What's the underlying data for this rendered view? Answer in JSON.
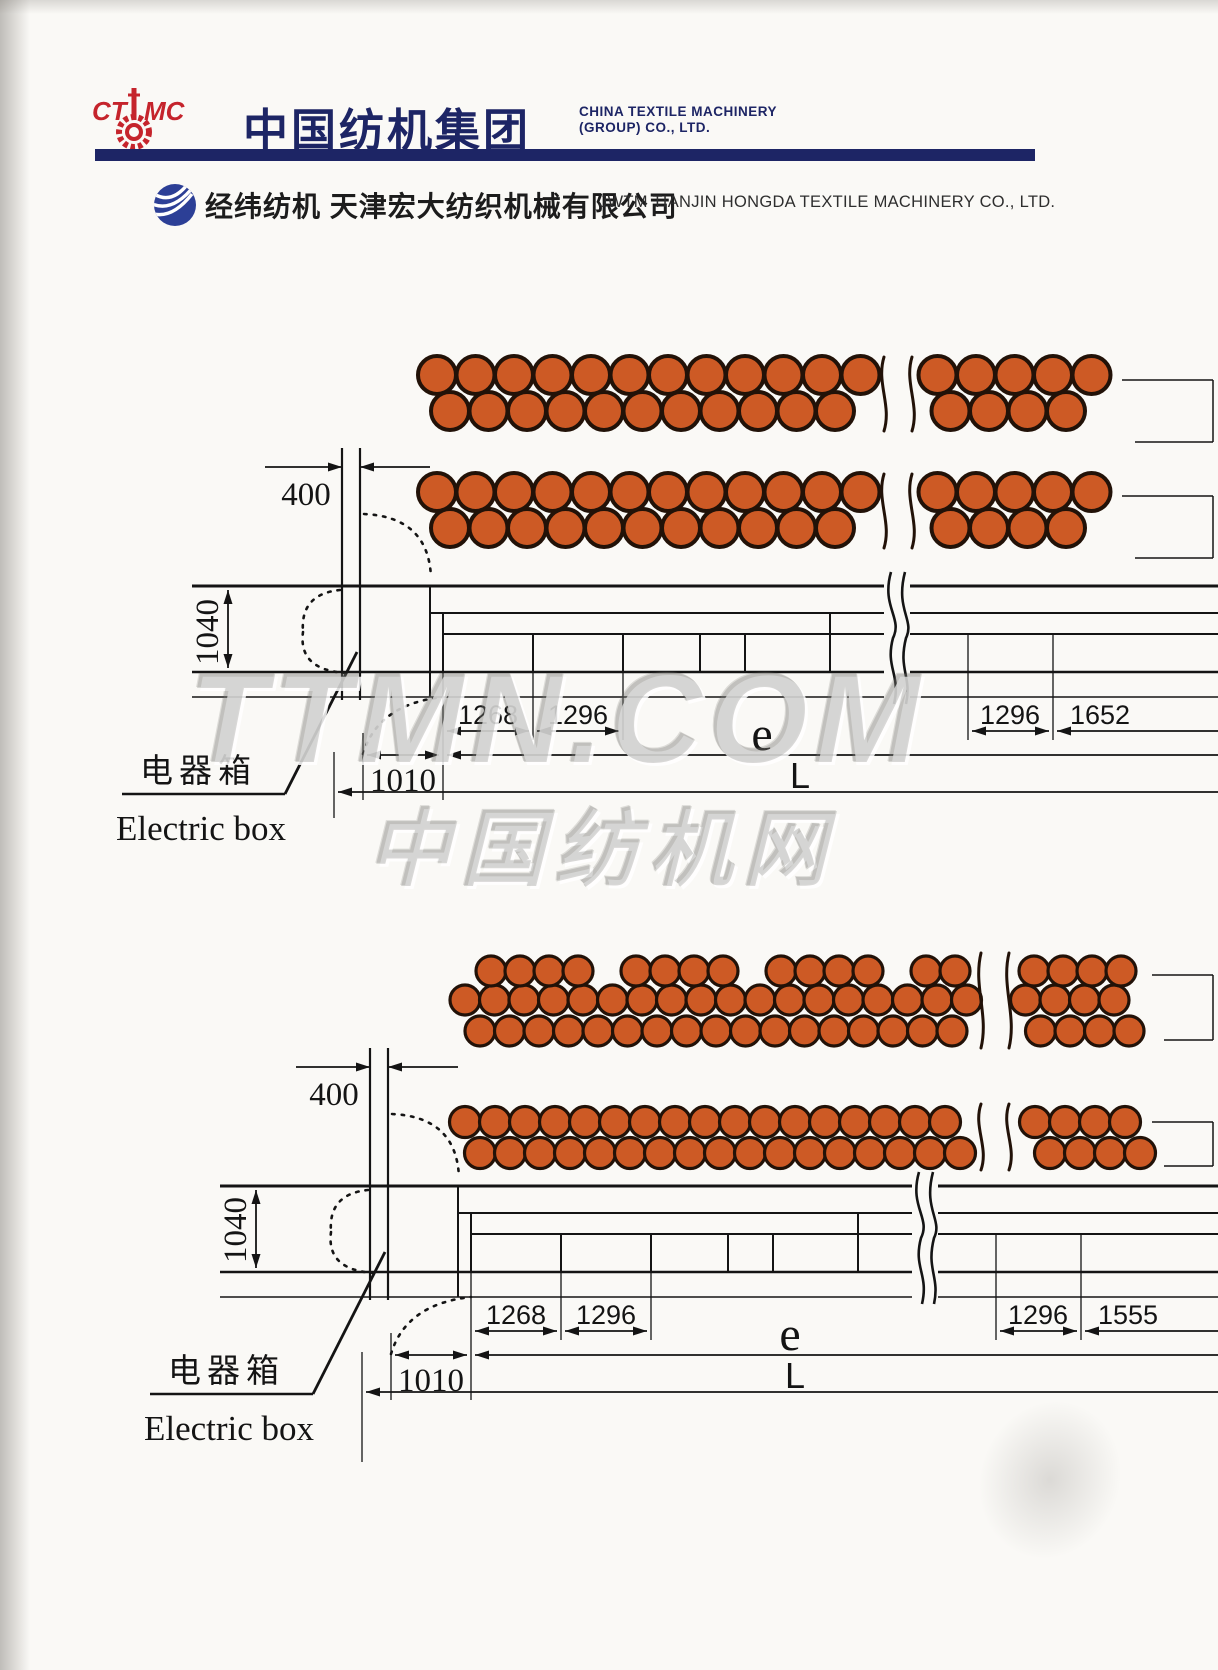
{
  "header": {
    "logo_acronym": "CTMC",
    "brand_cn": "中国纺机集团",
    "brand_en_line1": "CHINA TEXTILE MACHINERY",
    "brand_en_line2": "(GROUP) CO., LTD."
  },
  "subheader": {
    "company_cn": "经纬纺机  天津宏大纺织机械有限公司",
    "company_en": "JWTM TIANJIN HONGDA  TEXTILE MACHINERY CO.,  LTD."
  },
  "watermarks": {
    "site_latin": "TTMN.COM",
    "site_cn": "中国纺机网"
  },
  "colors": {
    "brand_navy": "#1d2565",
    "brand_red": "#c5242c",
    "bobbin_orange": "#cd5a25",
    "bobbin_outline": "#221208",
    "drawing_line": "#141414"
  },
  "diagram_top": {
    "labels": {
      "head_width": "400",
      "machine_depth": "1040",
      "seg_1": "1268",
      "seg_2": "1296",
      "seg_right": "1296",
      "seg_end": "1652",
      "head_length": "1010",
      "pitch_span": "e",
      "total_length": "L",
      "electric_box_cn": "电器箱",
      "electric_box_en": "Electric box"
    }
  },
  "diagram_bottom": {
    "labels": {
      "head_width": "400",
      "machine_depth": "1040",
      "seg_1": "1268",
      "seg_2": "1296",
      "seg_right": "1296",
      "seg_end": "1555",
      "head_length": "1010",
      "pitch_span": "e",
      "total_length": "L",
      "electric_box_cn": "电器箱",
      "electric_box_en": "Electric box"
    }
  }
}
